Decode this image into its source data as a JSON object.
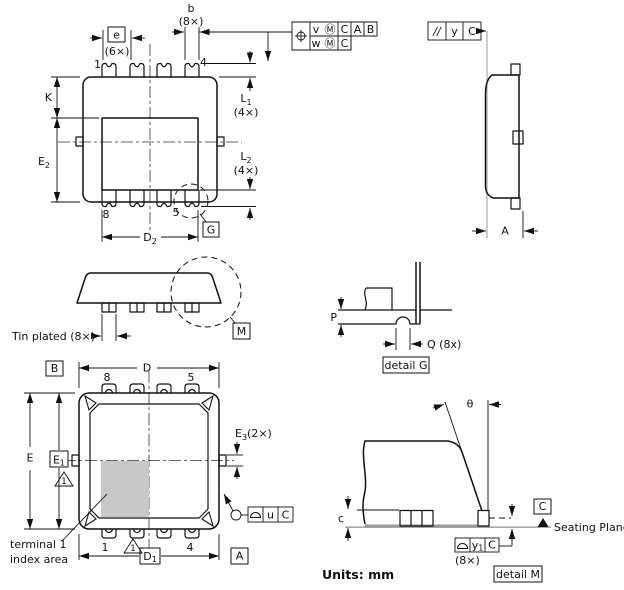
{
  "drawing": {
    "units_note": "Units: mm",
    "colors": {
      "line": "#111111",
      "gray": "#999999",
      "shade": "#c8c8c8",
      "background": "#ffffff"
    },
    "top_view": {
      "dim_b": "b",
      "dim_b_count": "(8×)",
      "dim_e": "e",
      "dim_e_count": "(6×)",
      "pin_top_left": "1",
      "pin_top_right": "4",
      "pin_bottom_left": "8",
      "pin_bottom_right": "5",
      "dim_k": "K",
      "dim_e2": {
        "main": "E",
        "sub": "2"
      },
      "dim_l1": {
        "main": "L",
        "sub": "1",
        "count": "(4×)"
      },
      "dim_l2": {
        "main": "L",
        "sub": "2",
        "count": "(4×)"
      },
      "dim_d2": {
        "main": "D",
        "sub": "2"
      },
      "detail_ref_g": "G"
    },
    "position_frame": {
      "symbol": "⌖",
      "row1": {
        "c1": "v",
        "c1m": "Ⓜ",
        "c2": "C",
        "c3": "A",
        "c4": "B"
      },
      "row2": {
        "c1": "w",
        "c1m": "Ⓜ",
        "c2": "C"
      }
    },
    "parallelism_frame": {
      "symbol": "//",
      "c1": "y",
      "c2": "C"
    },
    "side_view": {
      "dim_a": "A"
    },
    "side_elevation": {
      "tin_plated_label": "Tin plated (8×)",
      "detail_ref_m": "M"
    },
    "detail_g": {
      "dim_p": "P",
      "dim_q": "Q (8x)",
      "title": "detail G"
    },
    "bottom_view": {
      "datum_b": "B",
      "dim_d": "D",
      "pin_top_left": "8",
      "pin_top_right": "5",
      "dim_e": "E",
      "dim_e1": {
        "main": "E",
        "sub": "1"
      },
      "note_flag_left": "1",
      "note_flag_bottom": "1",
      "dim_e3": {
        "main": "E",
        "sub": "3",
        "count": "(2×)"
      },
      "index_note_line1": "terminal 1",
      "index_note_line2": "index area",
      "pin_bottom_left": "1",
      "pin_bottom_right": "4",
      "dim_d1": {
        "main": "D",
        "sub": "1"
      },
      "datum_a": "A",
      "profile_frame": {
        "symbol": "⌓",
        "c1": "u",
        "c2": "C"
      }
    },
    "detail_m": {
      "dim_theta": "θ",
      "dim_c": "c",
      "datum_c": "C",
      "seating_plane_label": "Seating Plane",
      "profile_frame": {
        "symbol": "⌓",
        "c1": {
          "main": "y",
          "sub": "1"
        },
        "c2": "C"
      },
      "frame_count": "(8×)",
      "title": "detail M"
    }
  }
}
